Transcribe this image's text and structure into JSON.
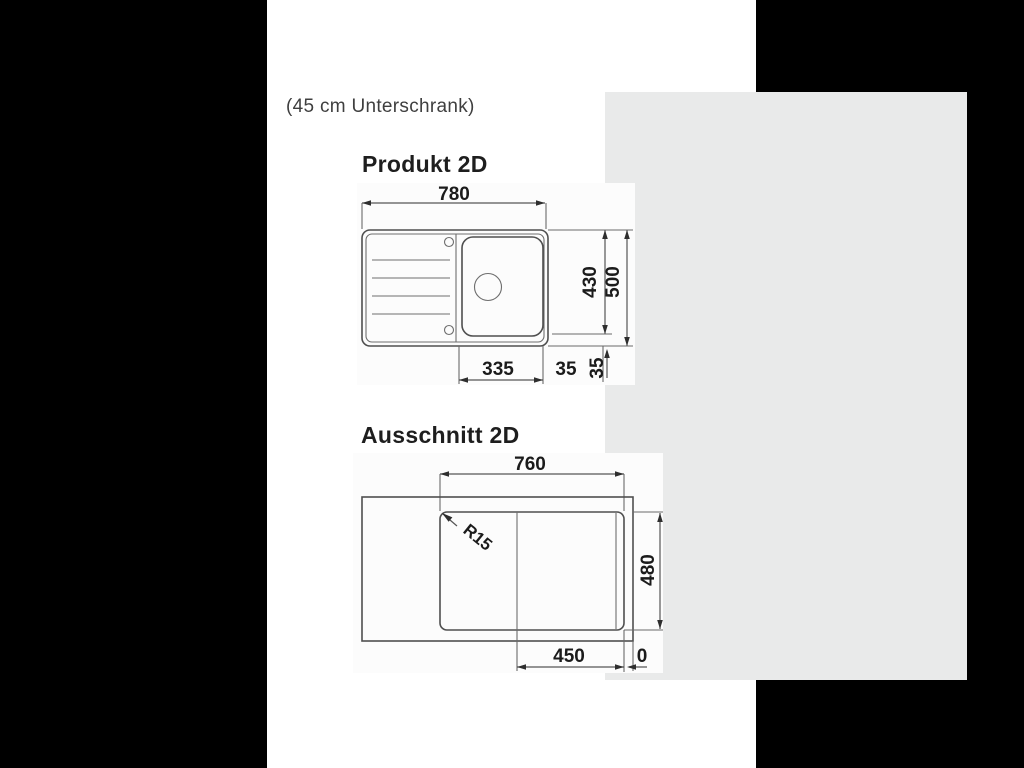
{
  "colors": {
    "page_background": "#000000",
    "sheet_background": "#ffffff",
    "panel_background": "#e9eaea",
    "drawing_line": "#4f4f4f",
    "text": "#1e1e1e"
  },
  "caption": "(45 cm Unterschrank)",
  "produkt": {
    "title": "Produkt 2D",
    "dims": {
      "overall_width": "780",
      "basin_zone_height": "430",
      "overall_depth": "500",
      "basin_offset": "335",
      "gap_horizontal": "35",
      "gap_vertical": "35"
    }
  },
  "ausschnitt": {
    "title": "Ausschnitt 2D",
    "dims": {
      "cutout_width": "760",
      "corner_radius": "R15",
      "cutout_depth": "480",
      "basin_offset": "450",
      "edge_distance": "0"
    }
  }
}
